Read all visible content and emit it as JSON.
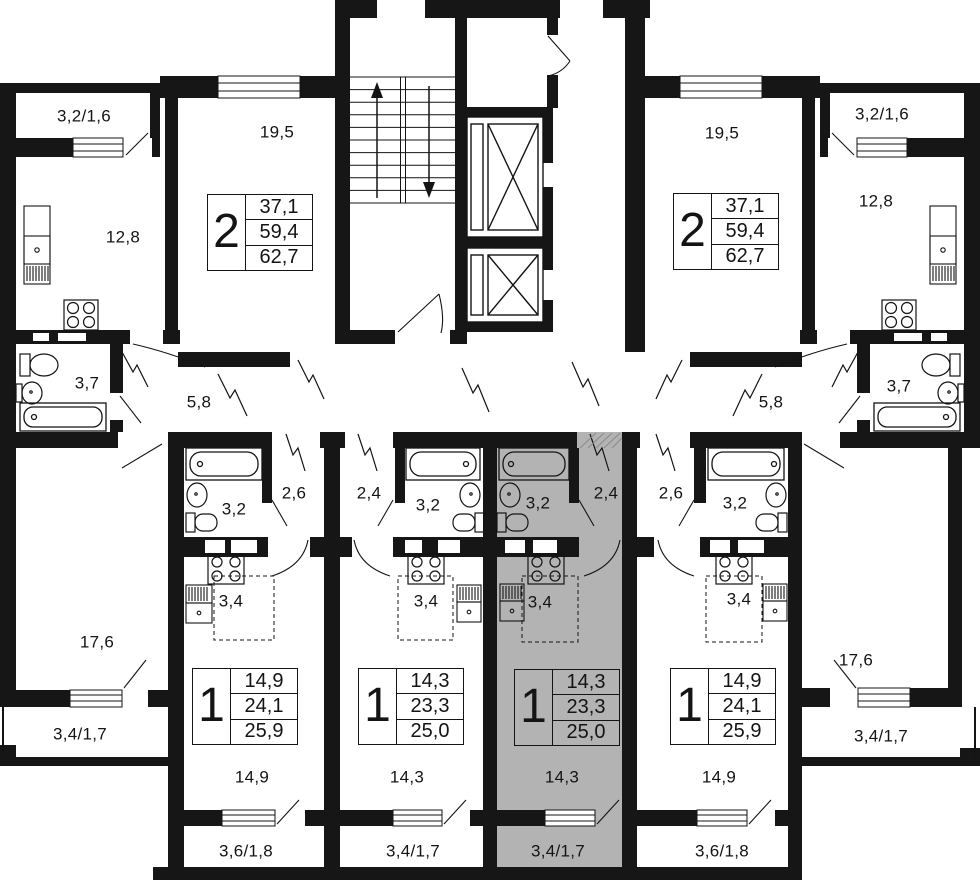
{
  "plan": {
    "type": "residential-floor-plan",
    "selected_apartment": "flat_c",
    "colors": {
      "walls": "#161616",
      "background": "#ffffff",
      "highlight": "#b3b3b3"
    }
  },
  "apartments": {
    "top_left": {
      "table": {
        "rooms": "2",
        "row1": "37,1",
        "row2": "59,4",
        "row3": "62,7"
      },
      "labels": {
        "balcony": "3,2/1,6",
        "living": "19,5",
        "kitchen": "12,8",
        "bath": "3,7",
        "hall": "5,8",
        "room2": "17,6",
        "balcony2": "3,4/1,7"
      }
    },
    "top_right": {
      "table": {
        "rooms": "2",
        "row1": "37,1",
        "row2": "59,4",
        "row3": "62,7"
      },
      "labels": {
        "balcony": "3,2/1,6",
        "living": "19,5",
        "kitchen": "12,8",
        "bath": "3,7",
        "hall": "5,8",
        "room2": "17,6",
        "balcony2": "3,4/1,7"
      }
    },
    "flat_a": {
      "table": {
        "rooms": "1",
        "row1": "14,9",
        "row2": "24,1",
        "row3": "25,9"
      },
      "labels": {
        "bath": "3,2",
        "hall": "2,6",
        "kitchen": "3,4",
        "room": "14,9",
        "balcony": "3,6/1,8"
      }
    },
    "flat_b": {
      "table": {
        "rooms": "1",
        "row1": "14,3",
        "row2": "23,3",
        "row3": "25,0"
      },
      "labels": {
        "hall": "2,4",
        "bath": "3,2",
        "kitchen": "3,4",
        "room": "14,3",
        "balcony": "3,4/1,7"
      }
    },
    "flat_c": {
      "selected": true,
      "table": {
        "rooms": "1",
        "row1": "14,3",
        "row2": "23,3",
        "row3": "25,0"
      },
      "labels": {
        "bath": "3,2",
        "hall": "2,4",
        "kitchen": "3,4",
        "room": "14,3",
        "balcony": "3,4/1,7"
      }
    },
    "flat_d": {
      "table": {
        "rooms": "1",
        "row1": "14,9",
        "row2": "24,1",
        "row3": "25,9"
      },
      "labels": {
        "hall": "2,6",
        "bath": "3,2",
        "kitchen": "3,4",
        "room": "14,9",
        "balcony": "3,6/1,8"
      }
    }
  }
}
